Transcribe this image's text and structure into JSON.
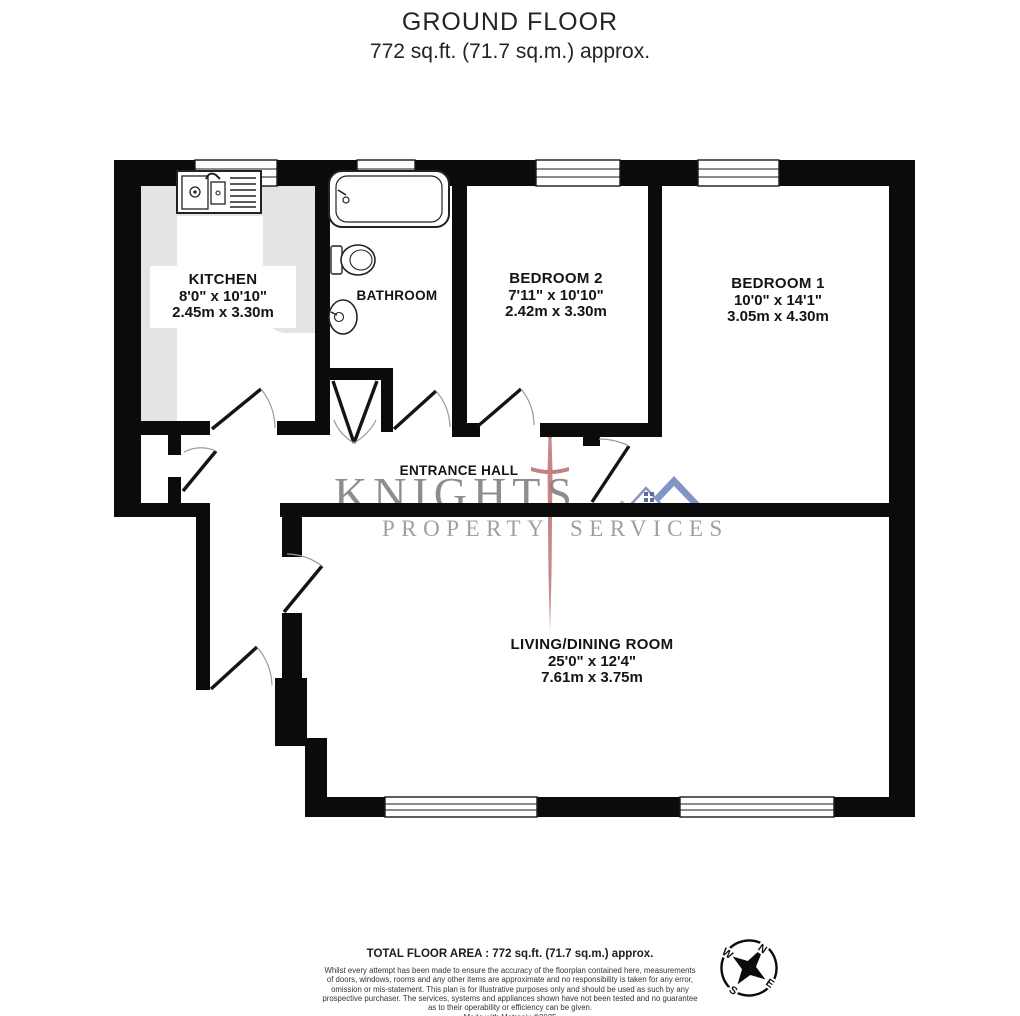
{
  "header": {
    "title": "GROUND FLOOR",
    "subtitle": "772 sq.ft. (71.7 sq.m.) approx."
  },
  "rooms": {
    "kitchen": {
      "name": "KITCHEN",
      "imperial": "8'0\" x 10'10\"",
      "metric": "2.45m x 3.30m"
    },
    "bathroom": {
      "name": "BATHROOM"
    },
    "bedroom2": {
      "name": "BEDROOM 2",
      "imperial": "7'11\" x 10'10\"",
      "metric": "2.42m x 3.30m"
    },
    "bedroom1": {
      "name": "BEDROOM 1",
      "imperial": "10'0\" x 14'1\"",
      "metric": "3.05m x 4.30m"
    },
    "entrance_hall": {
      "name": "ENTRANCE HALL"
    },
    "living_dining": {
      "name": "LIVING/DINING ROOM",
      "imperial": "25'0\" x 12'4\"",
      "metric": "7.61m x 3.75m"
    }
  },
  "watermark": {
    "brand": "KNIGHTS",
    "word1": "PROPERTY",
    "word2": "SERVICES",
    "sword_color": "#b86a6a",
    "roof_color": "#8495c5",
    "text_color": "#8d8d8d"
  },
  "compass": {
    "north": "N",
    "east": "E",
    "south": "S",
    "west": "W"
  },
  "footer": {
    "total_area": "TOTAL FLOOR AREA : 772 sq.ft. (71.7 sq.m.) approx.",
    "disclaimer": [
      "Whilst every attempt has been made to ensure the accuracy of the floorplan contained here, measurements",
      "of doors, windows, rooms and any other items are approximate and no responsibility is taken for any error,",
      "omission or mis-statement. This plan is for illustrative purposes only and should be used as such by any",
      "prospective purchaser. The services, systems and appliances shown have not been tested and no guarantee",
      "as to their operability or efficiency can be given."
    ],
    "credit": "Made with Metropix ©2025"
  },
  "colors": {
    "wall": "#0b0b0b",
    "counter": "#e4e4e4"
  }
}
